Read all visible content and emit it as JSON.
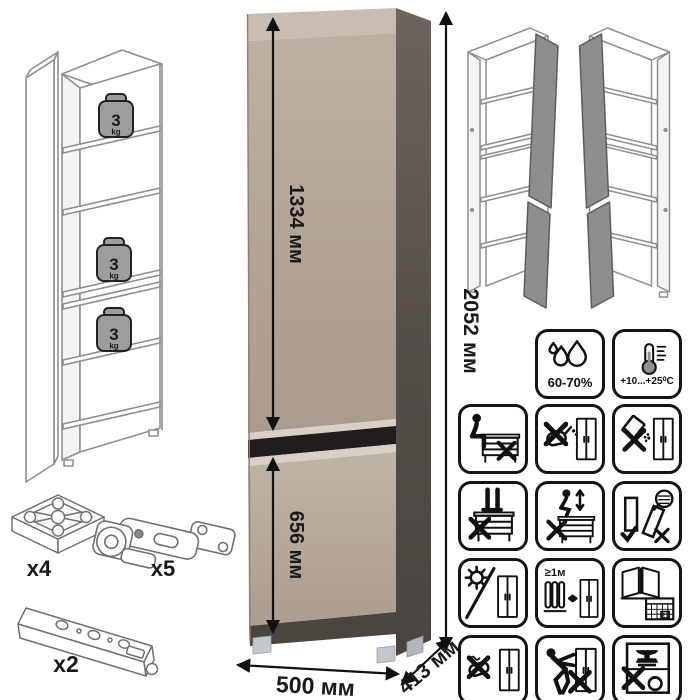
{
  "dims": {
    "upper": "1334 мм",
    "total": "2052 мм",
    "lower": "656 мм",
    "width": "500 мм",
    "depth": "413 мм"
  },
  "shelf_load": {
    "value": "3",
    "unit": "kg"
  },
  "hardware": {
    "foot_qty": "x4",
    "hinge_qty": "x5",
    "plinth_qty": "x2"
  },
  "climate": {
    "humidity": "60-70%",
    "temperature": "+10...+25⁰C"
  },
  "pictograms": {
    "min_heat_distance": "≥1м",
    "calendar_day": "21"
  },
  "icons": [
    "humidity-drops-icon",
    "thermometer-icon",
    "no-sitting-icon",
    "no-liquids-icon",
    "no-abrasive-powder-icon",
    "no-standing-icon",
    "no-jumping-icon",
    "store-panels-upright-icon",
    "no-direct-sunlight-icon",
    "keep-distance-from-heater-icon",
    "ventilate-room-icon",
    "no-harsh-scrubbing-icon",
    "no-dragging-icon",
    "no-heavy-objects-icon"
  ],
  "colors": {
    "door": "#b3a598",
    "door_light": "#c9bdb3",
    "side_panel": "#564f4b",
    "gap_black": "#201d1c",
    "line_gray": "#8f8f8f"
  }
}
